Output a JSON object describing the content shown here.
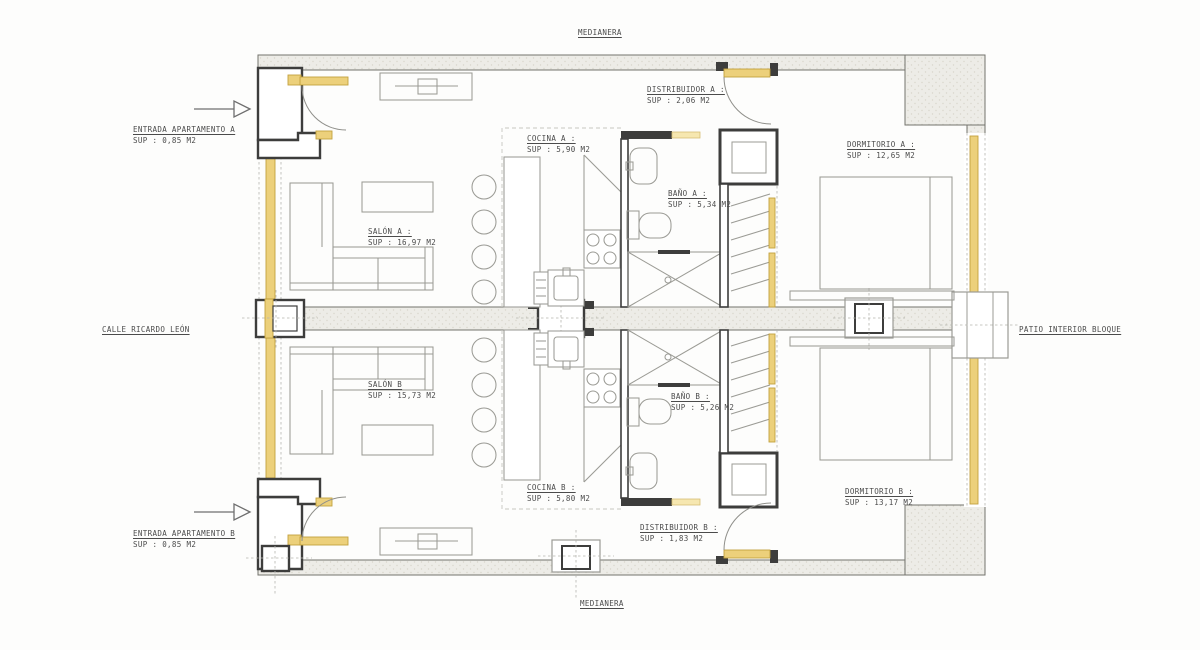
{
  "colors": {
    "background": "#fdfdfc",
    "wall_fill": "#edece7",
    "line_dark": "#3d3d3c",
    "line_furniture": "#9b9b95",
    "highlight_yellow": "#ecd07b",
    "text": "#4b4b4b"
  },
  "site_labels": {
    "top": "MEDIANERA",
    "bottom": "MEDIANERA",
    "left": "CALLE RICARDO LEÓN",
    "right": "PATIO INTERIOR BLOQUE"
  },
  "entrances": [
    {
      "id": "entrada-apartamento-a",
      "name": "ENTRADA APARTAMENTO A",
      "area": "SUP : 0,85 M2"
    },
    {
      "id": "entrada-apartamento-b",
      "name": "ENTRADA APARTAMENTO B",
      "area": "SUP : 0,85 M2"
    }
  ],
  "rooms": [
    {
      "id": "distribuidor-a",
      "name": "DISTRIBUIDOR  A :",
      "area": "SUP : 2,06 M2"
    },
    {
      "id": "cocina-a",
      "name": "COCINA A :",
      "area": "SUP : 5,90 M2"
    },
    {
      "id": "bano-a",
      "name": "BAÑO A :",
      "area": "SUP : 5,34 M2"
    },
    {
      "id": "dormitorio-a",
      "name": "DORMITORIO A :",
      "area": "SUP : 12,65 M2"
    },
    {
      "id": "salon-a",
      "name": "SALÓN A :",
      "area": "SUP : 16,97 M2"
    },
    {
      "id": "salon-b",
      "name": "SALÓN B",
      "area": "SUP : 15,73 M2"
    },
    {
      "id": "bano-b",
      "name": "BAÑO B :",
      "area": "SUP : 5,26 M2"
    },
    {
      "id": "cocina-b",
      "name": "COCINA B :",
      "area": "SUP : 5,80 M2"
    },
    {
      "id": "dormitorio-b",
      "name": "DORMITORIO B :",
      "area": "SUP : 13,17 M2"
    },
    {
      "id": "distribuidor-b",
      "name": "DISTRIBUIDOR  B :",
      "area": "SUP : 1,83 M2"
    }
  ]
}
